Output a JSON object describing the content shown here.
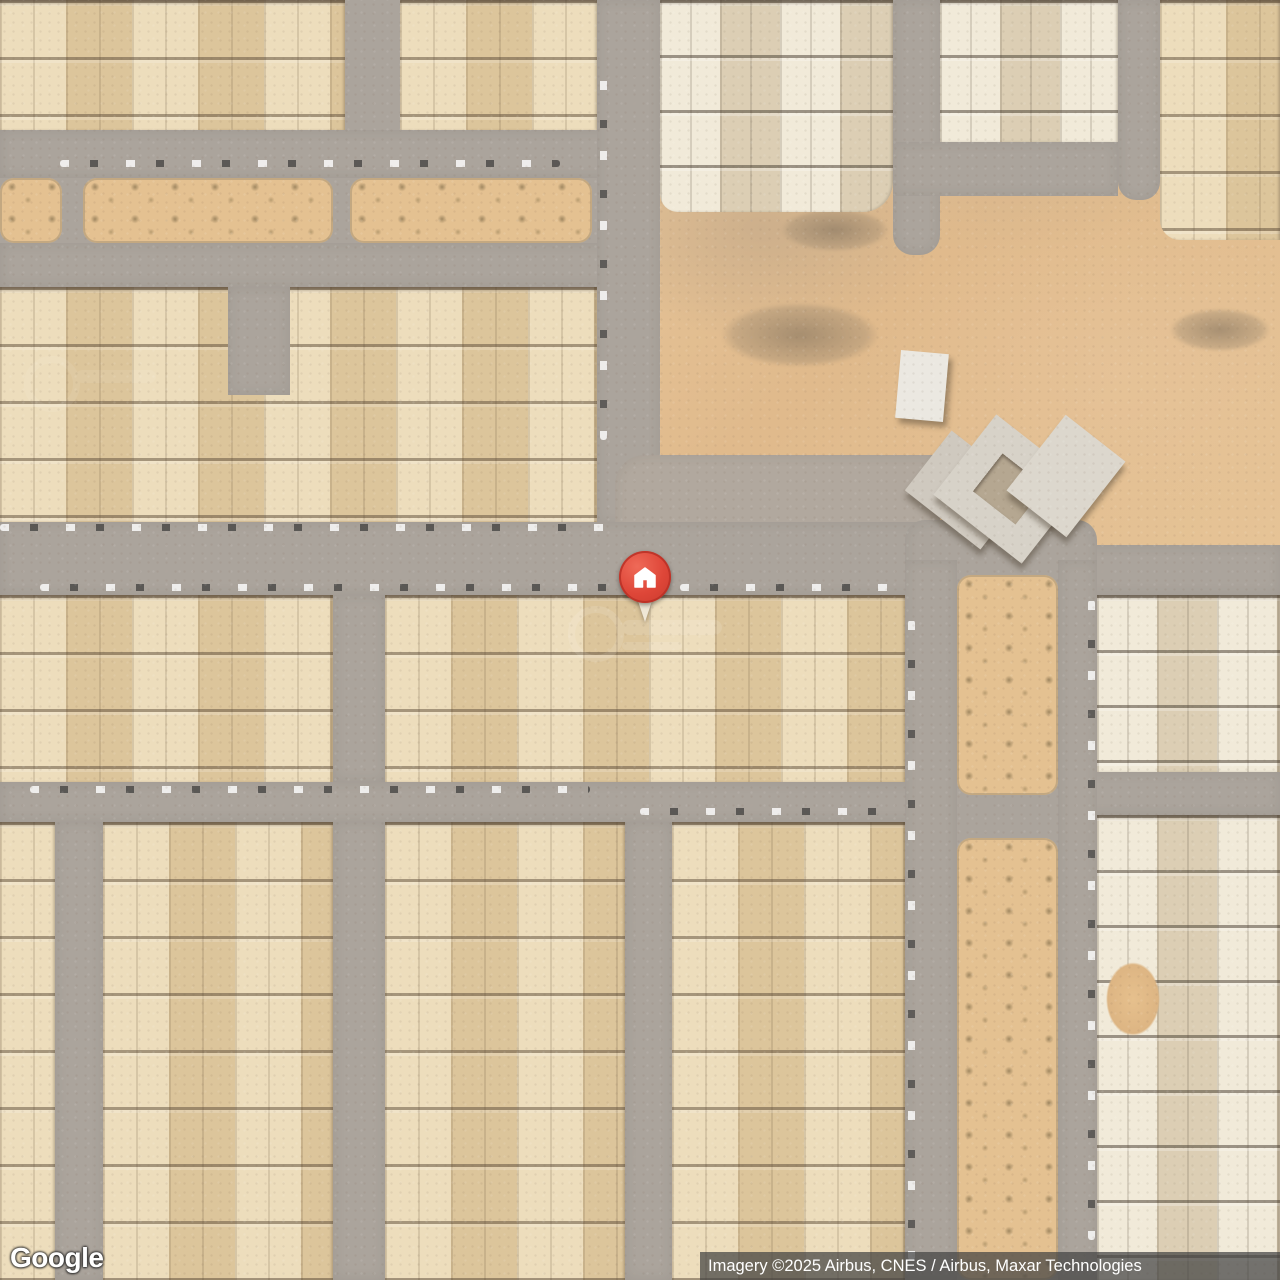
{
  "map": {
    "view_type": "satellite",
    "logo": {
      "text": "Google"
    },
    "attribution": {
      "text": "Imagery ©2025 Airbus, CNES / Airbus, Maxar Technologies"
    },
    "marker": {
      "shape": "red-circle-pin",
      "glyph": "home",
      "color": "#DE4638"
    },
    "colors": {
      "road": "#aba49c",
      "building_tan": "#e4d0a8",
      "building_cream": "#e7ddc5",
      "desert_sand": "#e2bd8e",
      "median_sand": "#e4c191",
      "marker_red": "#DE4638",
      "attribution_bg": "rgba(66,66,66,0.72)"
    }
  }
}
